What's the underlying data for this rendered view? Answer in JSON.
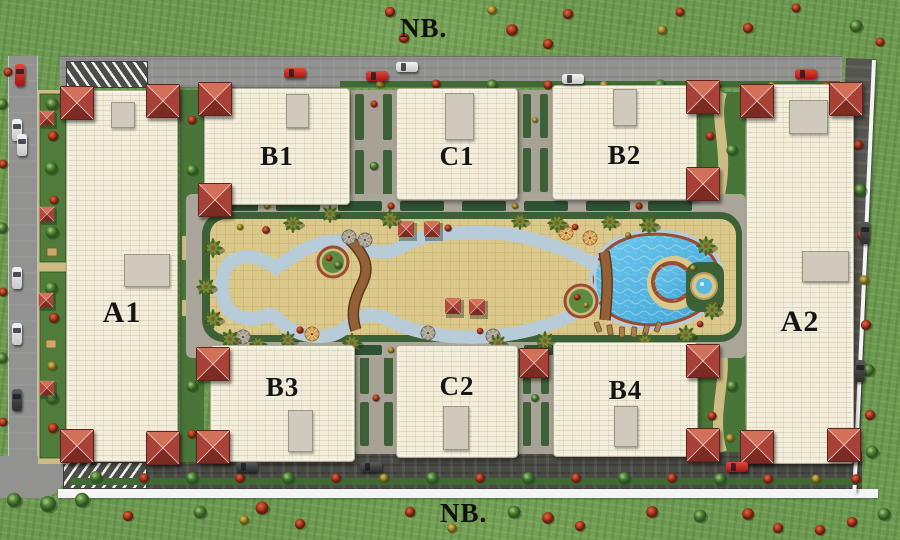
{
  "labels": {
    "north": "NB.",
    "south": "NB."
  },
  "buildings": {
    "A1": "A1",
    "A2": "A2",
    "B1": "B1",
    "B2": "B2",
    "B3": "B3",
    "B4": "B4",
    "C1": "C1",
    "C2": "C2"
  },
  "colors": {
    "grass": "#6d9a50",
    "building": "#f2eedb",
    "roof": "#b0493c",
    "pool_water": "#55b7e3",
    "pool_ring": "#9c4a30",
    "deck": "#dbc98c",
    "road_light": "#929290",
    "road_dark": "#4a4a44",
    "hedge": "#3d6136",
    "label_text": "#141414",
    "wall_white": "#f4f4f4"
  }
}
